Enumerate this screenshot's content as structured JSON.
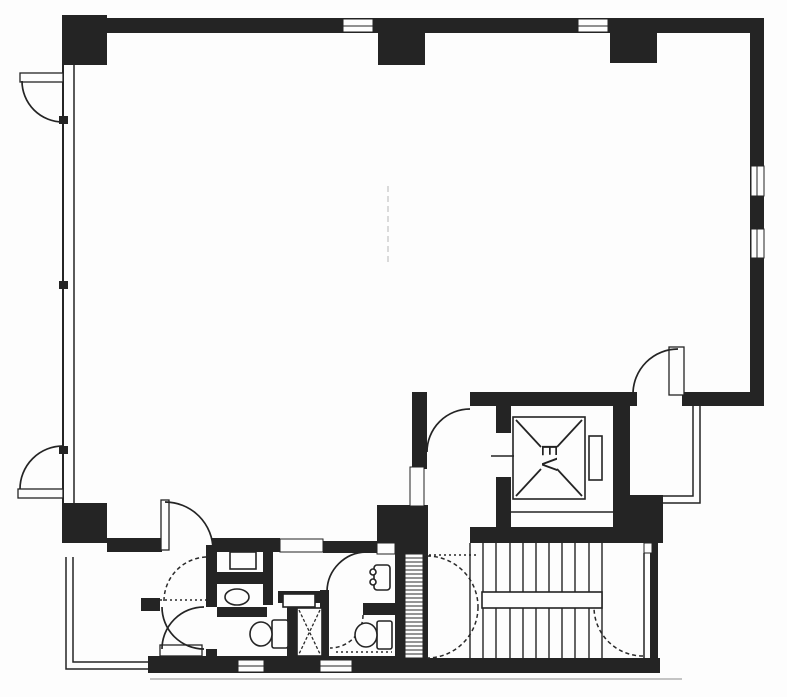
{
  "plan": {
    "elevator_label": "EV",
    "colors": {
      "wall": "#242424",
      "paper": "#fdfdfd",
      "accent_line": "#2a2a2a",
      "scan_artifact": "#cfcfcf"
    }
  }
}
